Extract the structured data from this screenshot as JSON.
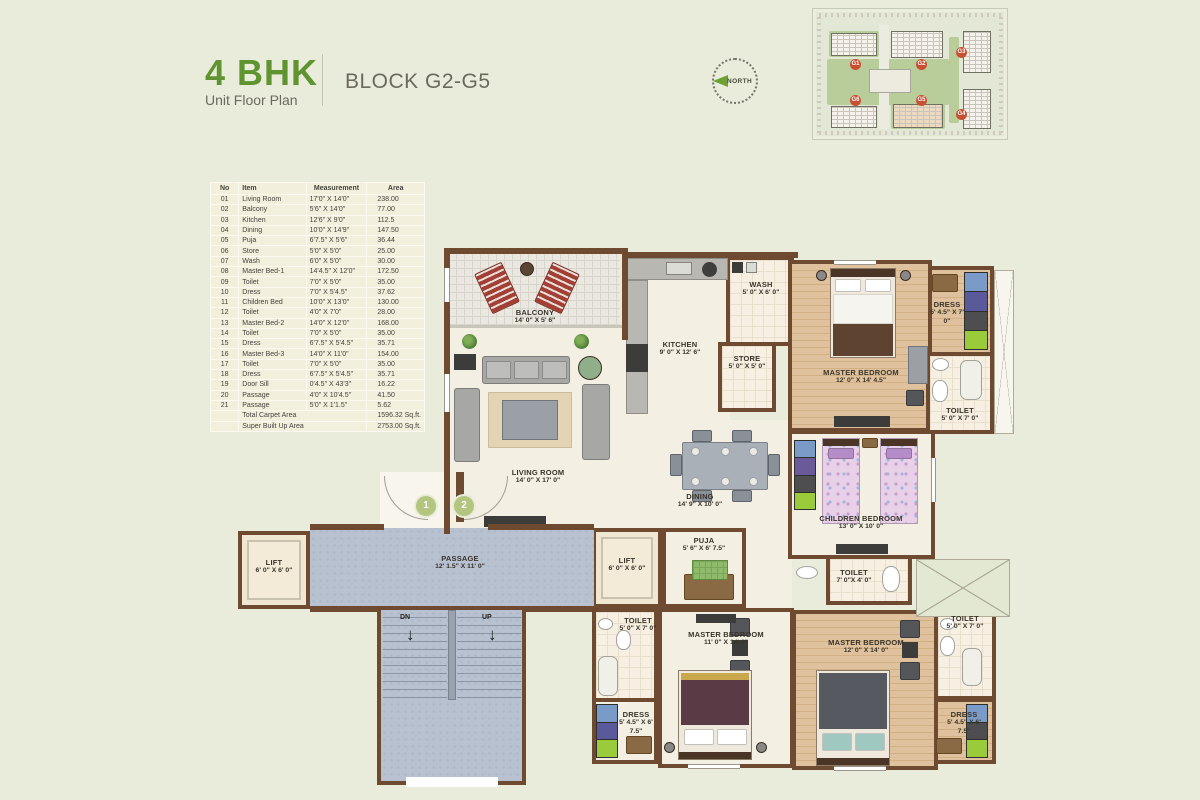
{
  "colors": {
    "accent": "#5f9431",
    "wall": "#6d4a30",
    "passage_blue": "#b7c1d0",
    "background": "#eaecdb"
  },
  "header": {
    "title": "4 BHK",
    "subtitle": "Unit Floor Plan",
    "block": "BLOCK G2-G5"
  },
  "north_label": "NORTH",
  "site_map": {
    "blocks": [
      "G1",
      "G2",
      "G3",
      "G6",
      "G5",
      "G4"
    ]
  },
  "area_table": {
    "columns": [
      "No",
      "Item",
      "Measurement",
      "Area"
    ],
    "rows": [
      [
        "01",
        "Living Room",
        "17'0\" X 14'0\"",
        "238.00"
      ],
      [
        "02",
        "Balcony",
        "5'6\" X 14'0\"",
        "77.00"
      ],
      [
        "03",
        "Kitchen",
        "12'6\" X 9'0\"",
        "112.5"
      ],
      [
        "04",
        "Dining",
        "10'0\" X 14'9\"",
        "147.50"
      ],
      [
        "05",
        "Puja",
        "6'7.5\" X 5'6\"",
        "36.44"
      ],
      [
        "06",
        "Store",
        "5'0\" X 5'0\"",
        "25.00"
      ],
      [
        "07",
        "Wash",
        "6'0\" X  5'0\"",
        "30.00"
      ],
      [
        "08",
        "Master Bed-1",
        "14'4.5\" X 12'0\"",
        "172.50"
      ],
      [
        "09",
        "Toilet",
        "7'0\" X 5'0\"",
        "35.00"
      ],
      [
        "10",
        "Dress",
        "7'0\" X 5'4.5\"",
        "37.62"
      ],
      [
        "11",
        "Children Bed",
        "10'0\" X 13'0\"",
        "130.00"
      ],
      [
        "12",
        "Toilet",
        "4'0\" X 7'0\"",
        "28.00"
      ],
      [
        "13",
        "Master Bed-2",
        "14'0\" X 12'0\"",
        "168.00"
      ],
      [
        "14",
        "Toilet",
        "7'0\" X 5'0\"",
        "35.00"
      ],
      [
        "15",
        "Dress",
        "6'7.5\" X 5'4.5\"",
        "35.71"
      ],
      [
        "16",
        "Master Bed-3",
        "14'0\" X 11'0\"",
        "154.00"
      ],
      [
        "17",
        "Toilet",
        "7'0\" X 5'0\"",
        "35.00"
      ],
      [
        "18",
        "Dress",
        "6'7.5\" X 5'4.5\"",
        "35.71"
      ],
      [
        "19",
        "Door Sill",
        "0'4.5\" X 43'3\"",
        "16.22"
      ],
      [
        "20",
        "Passage",
        "4'0\" X 10'4.5\"",
        "41.50"
      ],
      [
        "21",
        "Passage",
        "5'0\" X 1'1.5\"",
        "5.62"
      ]
    ],
    "totals": [
      {
        "label": "Total Carpet Area",
        "value": "1596.32 Sq.ft."
      },
      {
        "label": "Super Built Up Area",
        "value": "2753.00 Sq.ft."
      }
    ]
  },
  "plan": {
    "rooms": [
      {
        "name": "BALCONY",
        "dims": "14' 0\" X 5' 6\""
      },
      {
        "name": "LIVING ROOM",
        "dims": "14' 0\" X 17' 0\""
      },
      {
        "name": "KITCHEN",
        "dims": "9' 0\" X 12' 6\""
      },
      {
        "name": "WASH",
        "dims": "5' 0\" X 6' 0\""
      },
      {
        "name": "STORE",
        "dims": "5' 0\" X 5' 0\""
      },
      {
        "name": "MASTER BEDROOM",
        "dims": "12' 0\" X 14' 4.5\""
      },
      {
        "name": "DRESS",
        "dims": "5' 4.5\" X 7' 0\""
      },
      {
        "name": "TOILET",
        "dims": "5' 0\" X 7' 0\""
      },
      {
        "name": "DINING",
        "dims": "14' 9\" X 10' 0\""
      },
      {
        "name": "CHILDREN BEDROOM",
        "dims": "13' 0\" X 10' 0\""
      },
      {
        "name": "TOILET",
        "dims": "7' 0\"X 4' 0\""
      },
      {
        "name": "PUJA",
        "dims": "5' 6\" X 6' 7.5\""
      },
      {
        "name": "LIFT",
        "dims": "6' 0\" X 6' 0\""
      },
      {
        "name": "LIFT",
        "dims": "6' 0\" X 6' 0\""
      },
      {
        "name": "PASSAGE",
        "dims": "12' 1.5\" X 11' 0\""
      },
      {
        "name": "TOILET",
        "dims": "5' 0\" X 7' 0\""
      },
      {
        "name": "DRESS",
        "dims": "5' 4.5\" X 6' 7.5\""
      },
      {
        "name": "MASTER BEDROOM",
        "dims": "11' 0\" X 14' 0\""
      },
      {
        "name": "MASTER BEDROOM",
        "dims": "12' 0\" X 14' 0\""
      },
      {
        "name": "TOILET",
        "dims": "5' 0\" X 7' 0\""
      },
      {
        "name": "DRESS",
        "dims": "5' 4.5\" X 6' 7.5\""
      }
    ],
    "stairs": {
      "down": "DN",
      "up": "UP"
    },
    "doors": [
      "1",
      "2"
    ]
  }
}
